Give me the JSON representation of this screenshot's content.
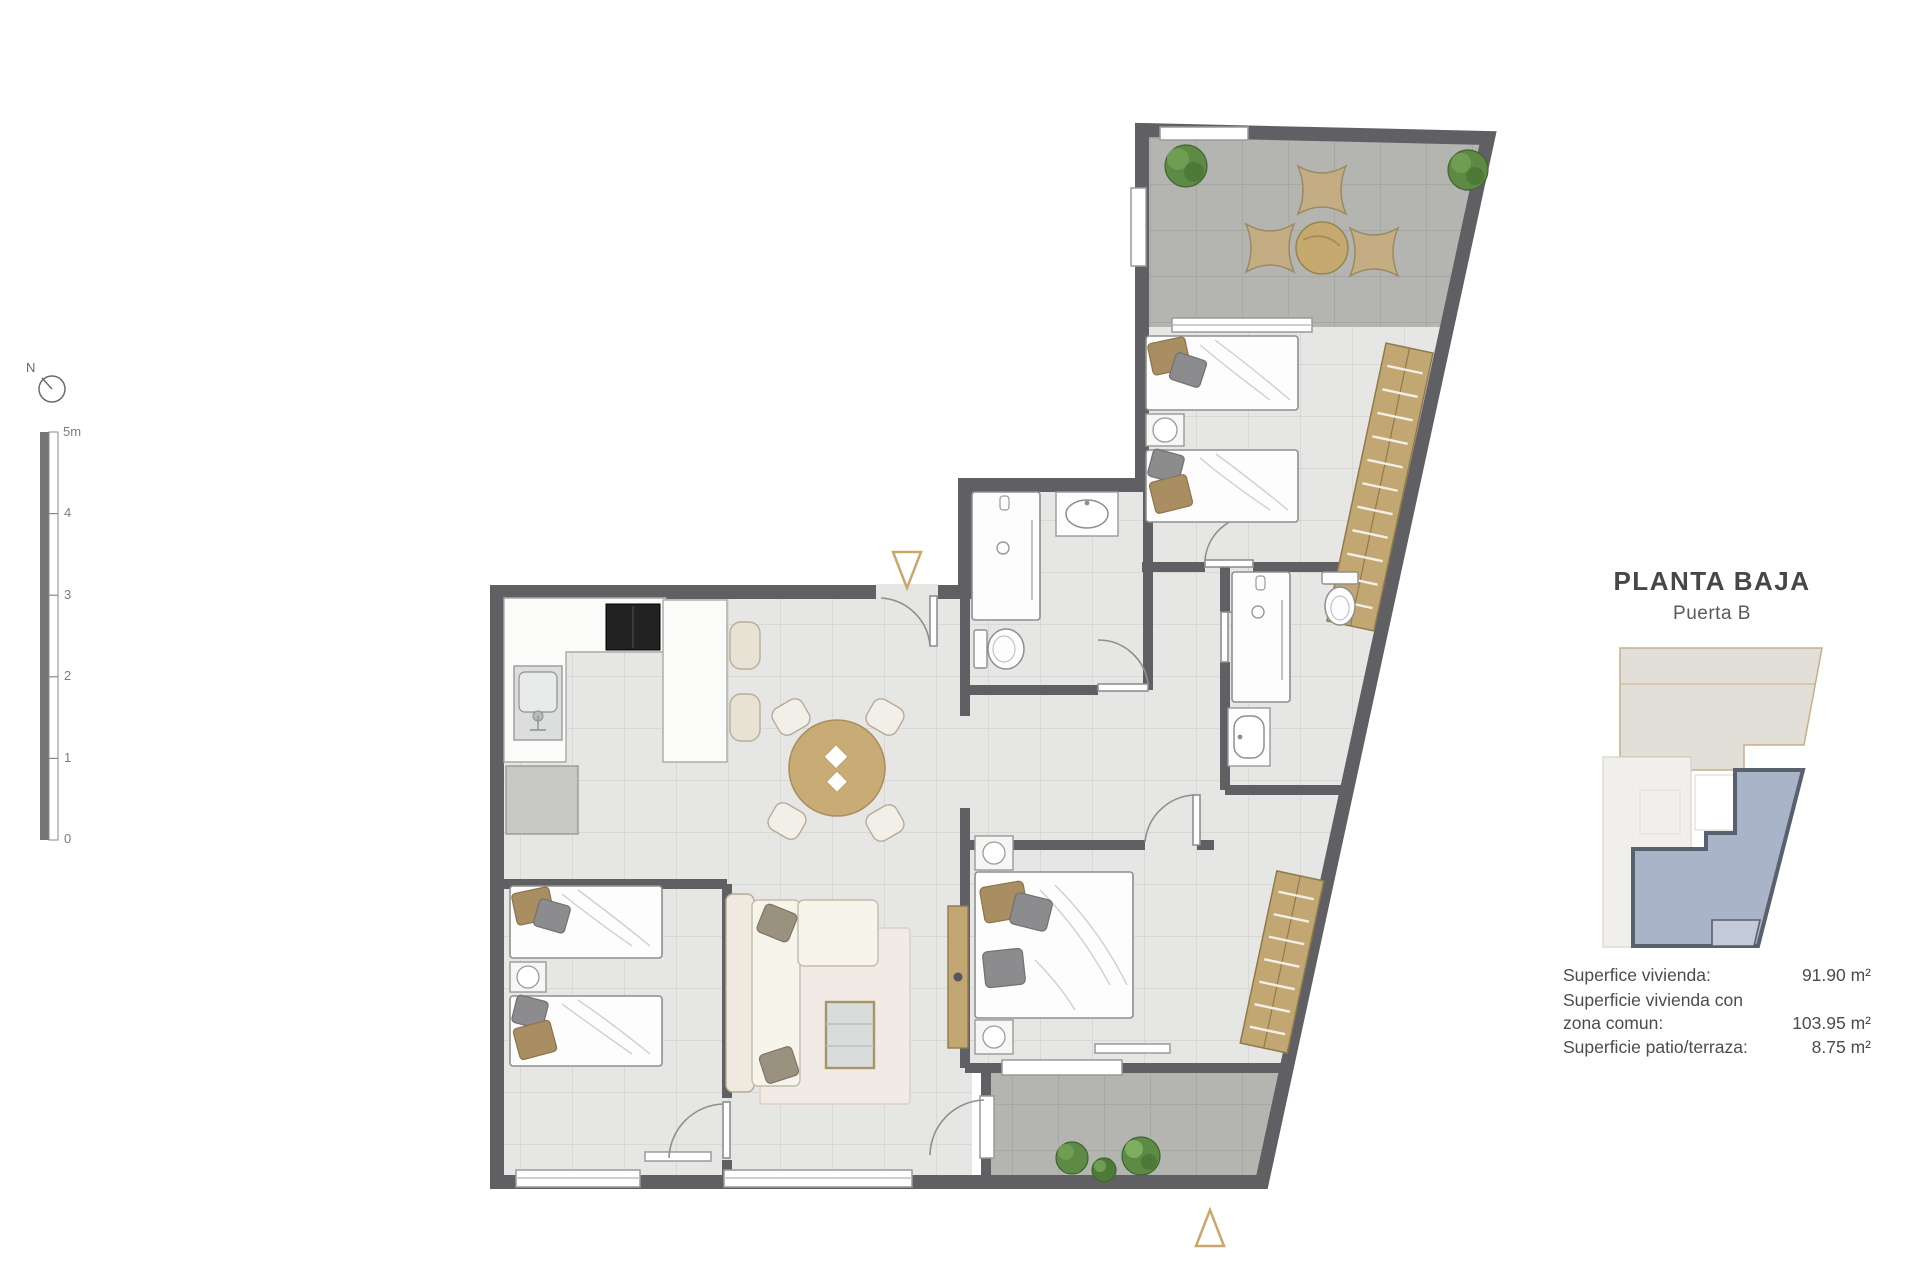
{
  "header": {
    "title": "PLANTA BAJA",
    "subtitle": "Puerta B"
  },
  "areas": {
    "rows": [
      {
        "label": "Superfice vivienda:",
        "value": "91.90 m²"
      },
      {
        "label": "Superficie vivienda con zona comun:",
        "value": "103.95 m²"
      },
      {
        "label": "Superficie patio/terraza:",
        "value": "8.75 m²"
      }
    ]
  },
  "compass": {
    "label": "N"
  },
  "scale_bar": {
    "max_label": "5m",
    "tick_labels": [
      "4",
      "3",
      "2",
      "1",
      "0"
    ]
  },
  "colors": {
    "wall": "#606064",
    "floor_tile": "#e6e6e4",
    "terrace_tile": "#b4b4b1",
    "wood": "#c2a772",
    "marker": "#c9a96a",
    "plant": "#5d8a44",
    "minimap_unit_fill": "#a9b4c9",
    "minimap_unit_border": "#59616f",
    "minimap_building_outline": "#c6af87",
    "text": "#4a4a4a"
  }
}
